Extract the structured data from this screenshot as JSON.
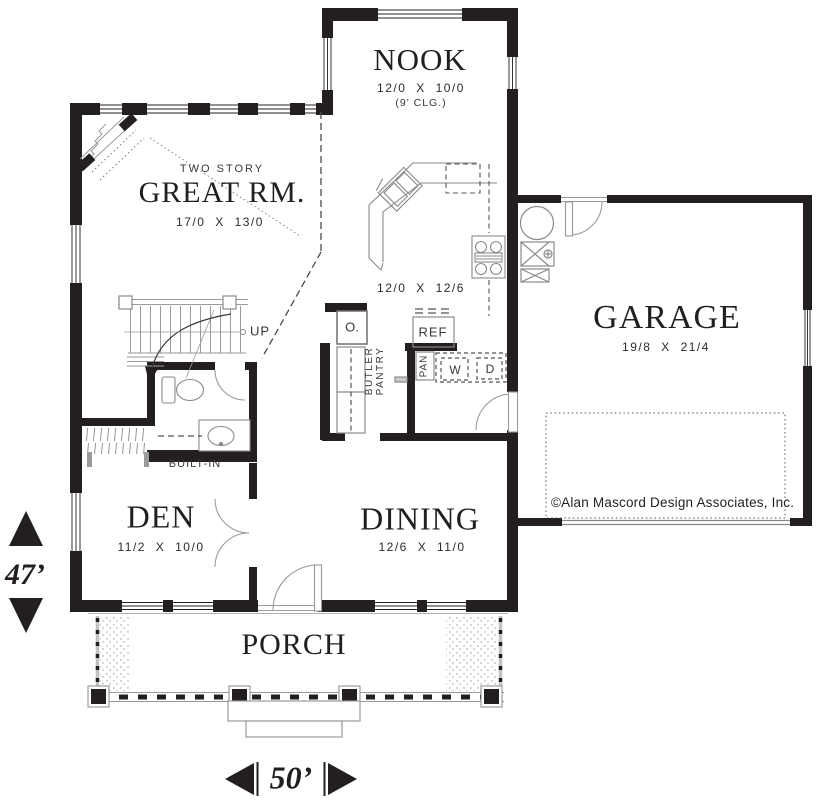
{
  "plan": {
    "rooms": {
      "nook": {
        "name": "NOOK",
        "dims": "12/0 X 10/0",
        "ceiling_note": "(9' CLG.)"
      },
      "great": {
        "note": "TWO STORY",
        "name": "GREAT RM.",
        "dims": "17/0 X 13/0"
      },
      "kitchen": {
        "dims": "12/0 X 12/6"
      },
      "garage": {
        "name": "GARAGE",
        "dims": "19/8 X 21/4"
      },
      "den": {
        "name": "DEN",
        "dims": "11/2 X 10/0"
      },
      "dining": {
        "name": "DINING",
        "dims": "12/6 X 11/0"
      },
      "porch": {
        "name": "PORCH"
      }
    },
    "annotations": {
      "up": "UP",
      "built_in": "BUILT-IN",
      "butler_line1": "BUTLER",
      "butler_line2": "PANTRY",
      "oven": "O.",
      "refrigerator": "REF",
      "pantry": "PAN",
      "washer": "W",
      "dryer": "D"
    },
    "overall_dimensions": {
      "height": "47’",
      "width": "50’"
    },
    "copyright": "©Alan Mascord Design Associates, Inc.",
    "colors": {
      "ink": "#231f20",
      "line_gray": "#9a9a9a",
      "dash_gray": "#4c4c4c",
      "background": "#ffffff"
    }
  }
}
